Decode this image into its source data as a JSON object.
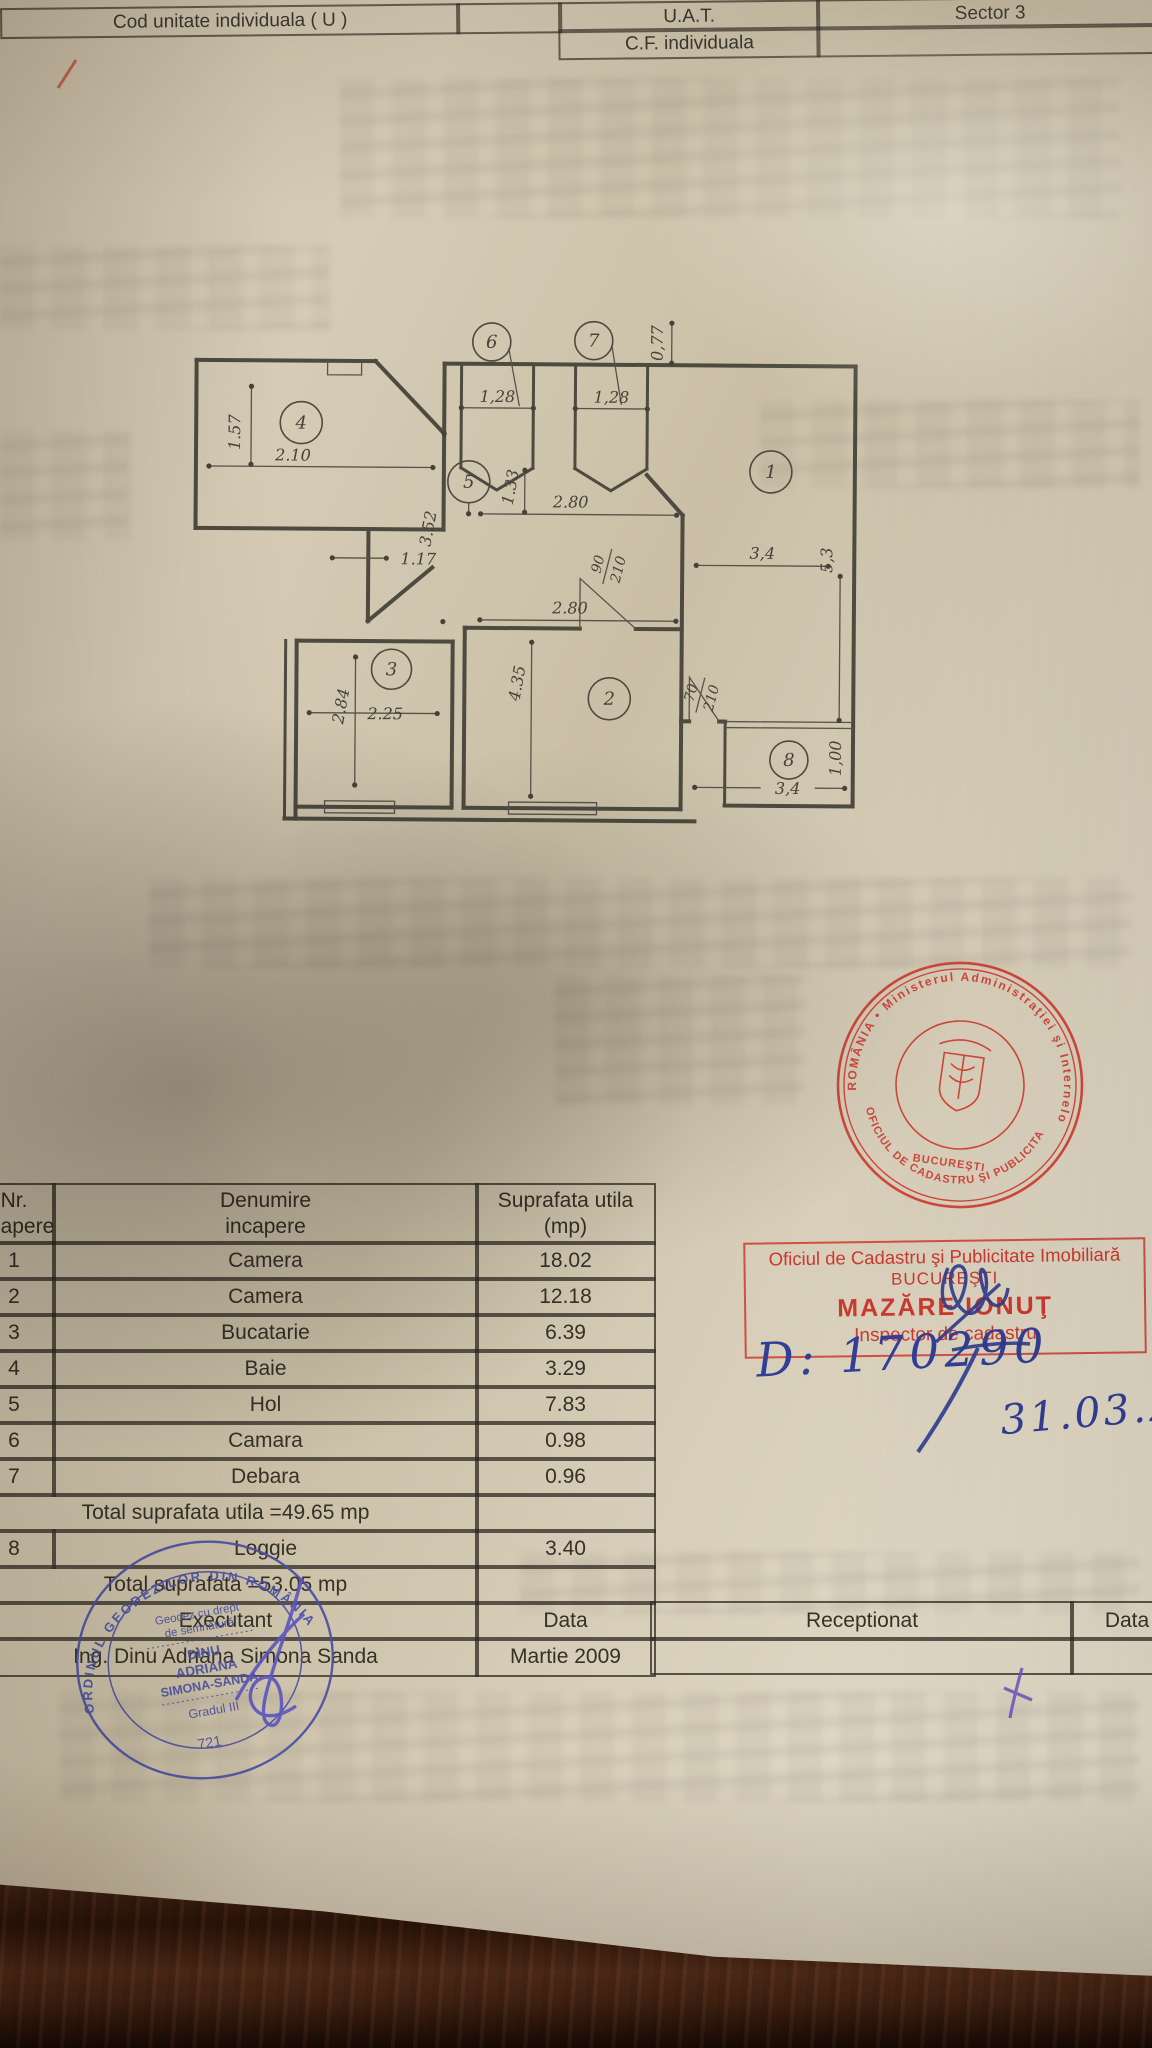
{
  "header_bar": {
    "cod_unitate": "Cod unitate individuala ( U )",
    "uat": "U.A.T.",
    "sector": "Sector 3",
    "cf": "C.F. individuala"
  },
  "plan": {
    "rooms": {
      "r1": "1",
      "r2": "2",
      "r3": "3",
      "r4": "4",
      "r5": "5",
      "r6": "6",
      "r7": "7",
      "r8": "8"
    },
    "dims": {
      "d157": "1.57",
      "d210": "2.10",
      "d128a": "1,28",
      "d128b": "1,28",
      "d077": "0,77",
      "d352": "3.52",
      "d133": "1.33",
      "d280a": "2.80",
      "d117": "1.17",
      "d280b": "2.80",
      "d284": "2.84",
      "d225": "2.25",
      "d435": "4.35",
      "d34a": "3,4",
      "d53": "5,3",
      "d34b": "3,4",
      "d100": "1,00"
    },
    "doors": {
      "d90_num": "90",
      "d90_den": "210",
      "d70_num": "70",
      "d70_den": "210"
    }
  },
  "round_stamp": {
    "arc_top": "ROMÂNIA • Ministerul Administraţiei şi Internelor •",
    "arc_bottom": "OFICIUL DE CADASTRU ŞI PUBLICITATE IMOBILIARĂ",
    "city": "BUCUREŞTI"
  },
  "approval_stamp": {
    "line1": "Oficiul de Cadastru şi Publicitate Imobiliară",
    "line2": "BUCUREŞTI",
    "line3": "MAZĂRE IONUŢ",
    "line4": "Inspector de cadastru"
  },
  "handwriting": {
    "number": "D: 170290",
    "date": "31.03.200"
  },
  "table": {
    "col0_line1": "Nr.",
    "col0_line2": "incapere",
    "col1_line1": "Denumire",
    "col1_line2": "incapere",
    "col2_line1": "Suprafata utila",
    "col2_line2": "(mp)",
    "rows": [
      {
        "nr": "1",
        "name": "Camera",
        "area": "18.02"
      },
      {
        "nr": "2",
        "name": "Camera",
        "area": "12.18"
      },
      {
        "nr": "3",
        "name": "Bucatarie",
        "area": "6.39"
      },
      {
        "nr": "4",
        "name": "Baie",
        "area": "3.29"
      },
      {
        "nr": "5",
        "name": "Hol",
        "area": "7.83"
      },
      {
        "nr": "6",
        "name": "Camara",
        "area": "0.98"
      },
      {
        "nr": "7",
        "name": "Debara",
        "area": "0.96"
      }
    ],
    "total_utila": "Total suprafata utila =49.65 mp",
    "loggie": {
      "nr": "8",
      "name": "Loggie",
      "area": "3.40"
    },
    "total": "Total suprafata =53.05 mp",
    "executant_label": "Executant",
    "data_label": "Data",
    "executant": "Ing. Dinu Adriana Simona Sanda",
    "date": "Martie 2009",
    "receptionat_label": "Receptionat",
    "data_label2": "Data"
  },
  "surveyor_stamp": {
    "ring": "ORDINUL GEODEZILOR DIN ROMÂNIA",
    "l1": "Geodez cu drept",
    "l2": "de semnătură",
    "name1": "DINU",
    "name2": "ADRIANA",
    "name3": "SIMONA-SANDA",
    "grade": "Gradul III",
    "number": "721"
  }
}
